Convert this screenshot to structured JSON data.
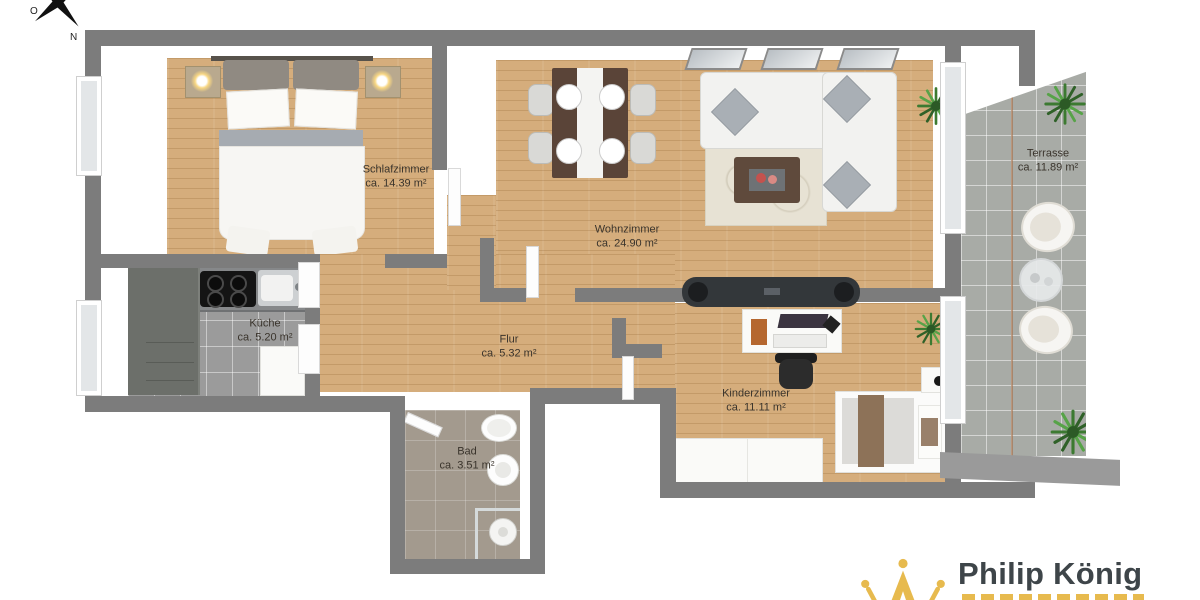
{
  "compass": {
    "labels": {
      "east": "O",
      "north": "N"
    }
  },
  "rooms": [
    {
      "key": "schlafzimmer",
      "name": "Schlafzimmer",
      "area": "ca. 14.39 m²"
    },
    {
      "key": "wohnzimmer",
      "name": "Wohnzimmer",
      "area": "ca. 24.90 m²"
    },
    {
      "key": "kueche",
      "name": "Küche",
      "area": "ca. 5.20 m²"
    },
    {
      "key": "flur",
      "name": "Flur",
      "area": "ca. 5.32 m²"
    },
    {
      "key": "bad",
      "name": "Bad",
      "area": "ca. 3.51 m²"
    },
    {
      "key": "kinderzimmer",
      "name": "Kinderzimmer",
      "area": "ca. 11.11 m²"
    },
    {
      "key": "terrasse",
      "name": "Terrasse",
      "area": "ca. 11.89 m²"
    }
  ],
  "logo": {
    "brand": "Philip König"
  },
  "colors": {
    "wall": "#7c7c7c",
    "wood_floor": "#d5ad7c",
    "kitchen_tile": "#9b9b9b",
    "bath_tile": "#a39a8e",
    "terrace_tile": "#a8aba6",
    "logo_gold": "#e7ba4e",
    "logo_text": "#3e4549"
  }
}
